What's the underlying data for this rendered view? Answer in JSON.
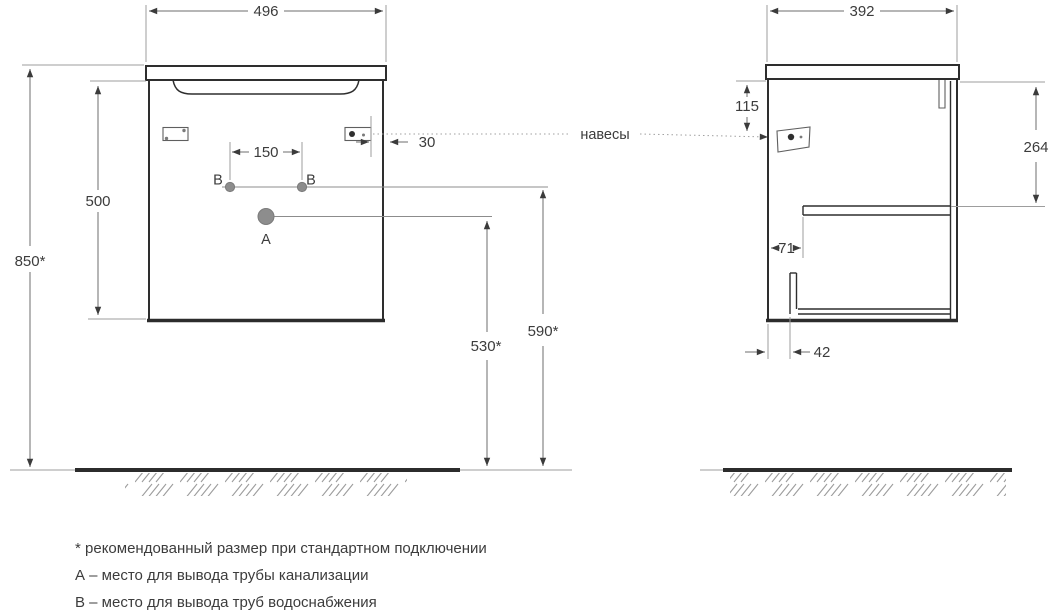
{
  "front_view": {
    "width": "496",
    "overall_height": "850*",
    "cabinet_height": "500",
    "hole_spacing": "150",
    "hanger_offset": "30",
    "drain_height": "530*",
    "supply_height": "590*",
    "point_a": "А",
    "point_b_left": "В",
    "point_b_right": "В"
  },
  "side_view": {
    "depth": "392",
    "hanger_drop": "115",
    "shelf_drop": "264",
    "shelf_inset": "71",
    "bottom_inset": "42"
  },
  "callout": {
    "hangers": "навесы"
  },
  "legend": {
    "note_asterisk": "* рекомендованный размер при стандартном подключении",
    "note_a": "А – место для вывода трубы канализации",
    "note_b": "В – место для вывода труб водоснабжения"
  },
  "colors": {
    "outline": "#2e2e2e",
    "dimension": "#6e6e6e",
    "extension": "#9d9d9d",
    "text": "#3c3c3c",
    "point_fill": "#8d8d8d",
    "background": "#ffffff"
  }
}
